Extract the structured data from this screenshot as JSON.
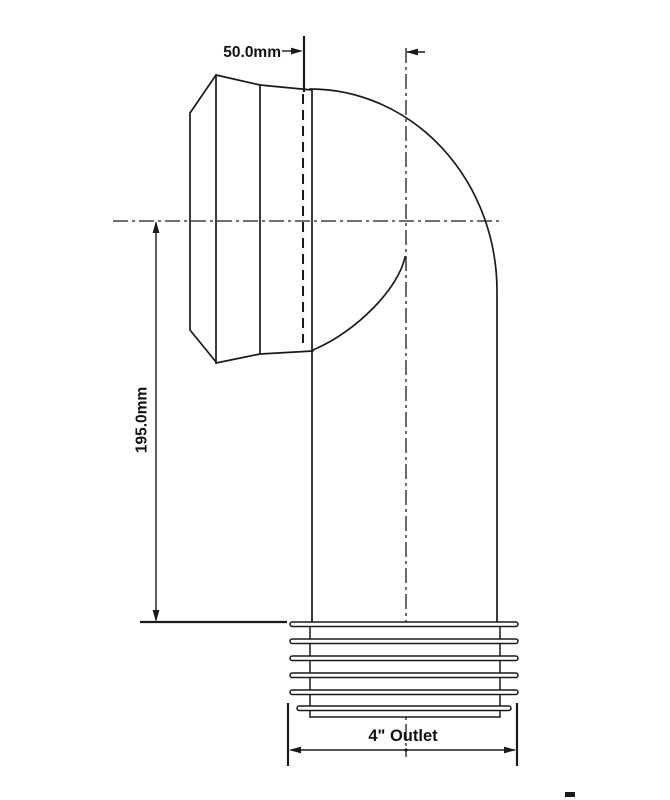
{
  "drawing": {
    "background_color": "#ffffff",
    "line_color": "#1a1a1a",
    "subject": "90 degree WC pan connector side elevation",
    "dimensions": {
      "offset": {
        "label": "50.0mm"
      },
      "height": {
        "label": "195.0mm"
      },
      "outlet": {
        "label": "4\" Outlet"
      }
    },
    "fin_count": 6
  }
}
